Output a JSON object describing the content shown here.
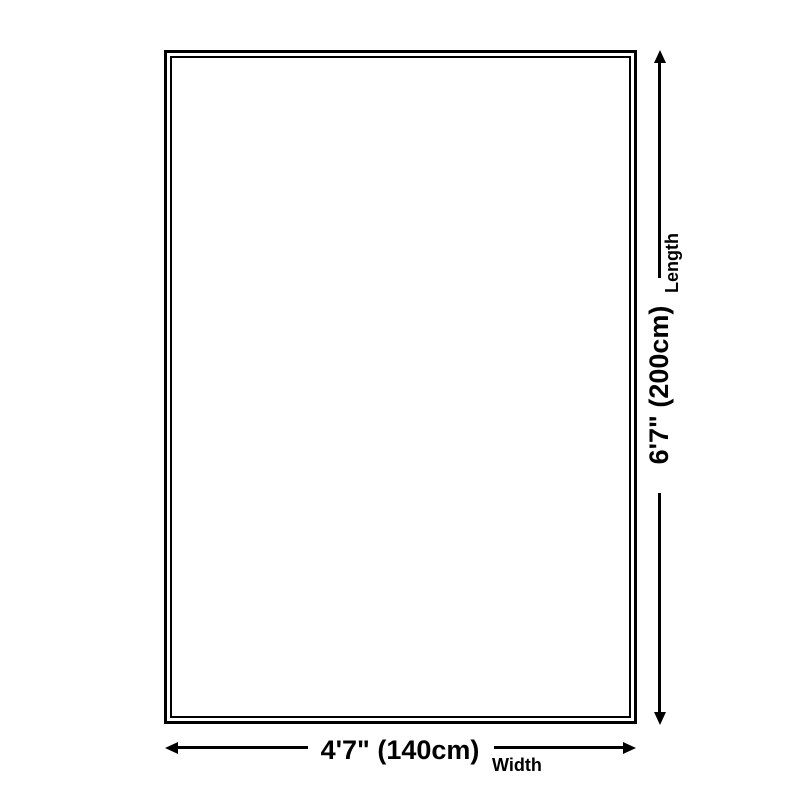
{
  "diagram": {
    "colors": {
      "background": "#ffffff",
      "line": "#000000",
      "text": "#000000"
    },
    "length": {
      "value": "6'7\" (200cm)",
      "label": "Length"
    },
    "width": {
      "value": "4'7\" (140cm)",
      "label": "Width"
    }
  }
}
